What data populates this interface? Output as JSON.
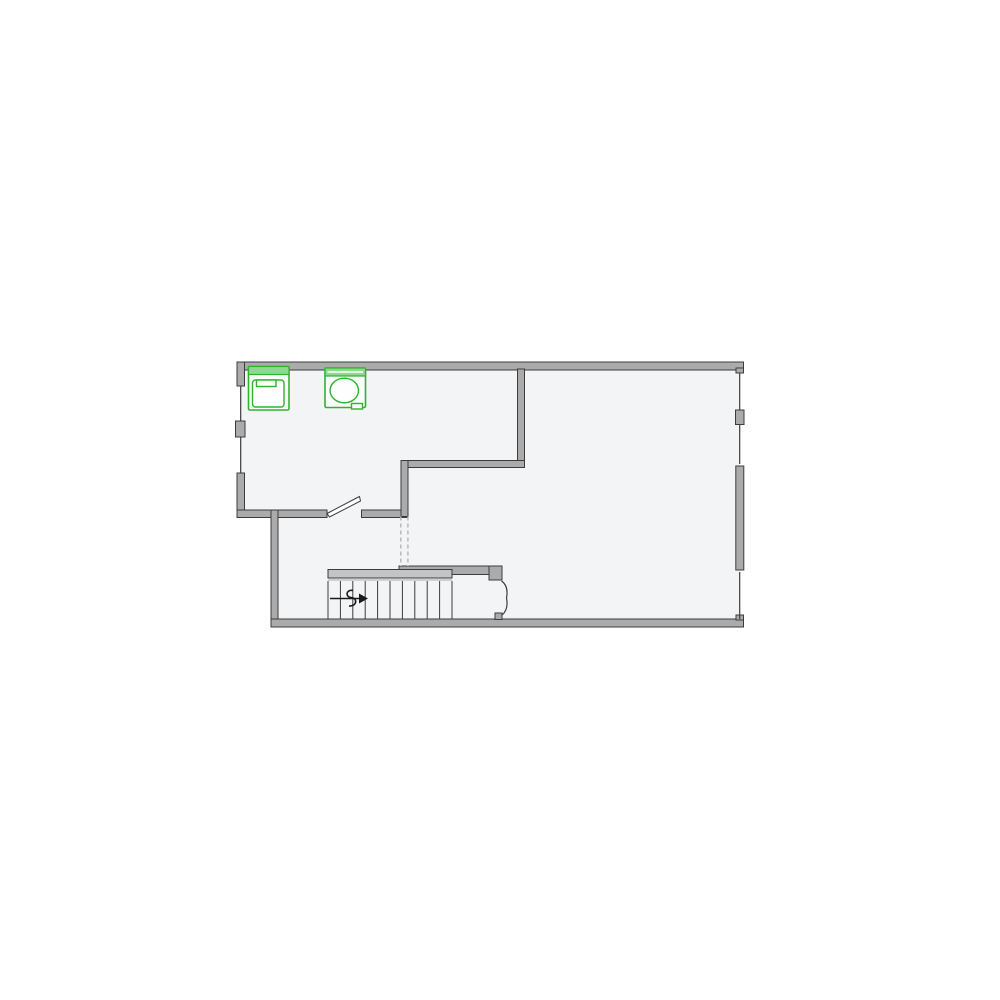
{
  "app": {
    "type": "architectural-floor-plan",
    "title": "Floor Plan"
  },
  "colors": {
    "page_bg": "#ffffff",
    "floor_fill": "#f3f4f6",
    "wall_fill": "#ababab",
    "wall_edge": "#3c3c3c",
    "stair_bar": "#c4c4c4",
    "stair_under": "#cfcfcf",
    "tread": "#3c3c3c",
    "dashed": "#b5b5b5",
    "arrow": "#1a1a1a",
    "door_line": "#3c3c3c",
    "fixture_green": "#2cb52c",
    "fixture_strip": "#8ed98e",
    "fixture_body": "#fbfdfb"
  },
  "plan": {
    "rooms": [
      {
        "name": "laundry-room",
        "position": "top-left",
        "contents": [
          "washer",
          "washing-machine"
        ]
      },
      {
        "name": "main-room",
        "position": "right",
        "contents": []
      },
      {
        "name": "stair-hall",
        "position": "bottom-left",
        "contents": [
          "staircase"
        ]
      }
    ],
    "fixtures": [
      {
        "name": "washer",
        "color": "#2cb52c",
        "selected_style": "green-outline"
      },
      {
        "name": "washing-machine",
        "color": "#2cb52c",
        "selected_style": "green-outline"
      }
    ],
    "windows": [
      {
        "wall": "left",
        "count": 2
      },
      {
        "wall": "right",
        "count": 3
      }
    ],
    "doors": [
      {
        "name": "laundry-door",
        "type": "single-swing"
      },
      {
        "name": "hall-double-door",
        "type": "double-swing"
      }
    ],
    "stairs": {
      "direction": "up",
      "x": 328,
      "tread_spacing": 12.4,
      "tread_count": 11,
      "treads_y1": 581,
      "treads_y2": 619
    }
  }
}
